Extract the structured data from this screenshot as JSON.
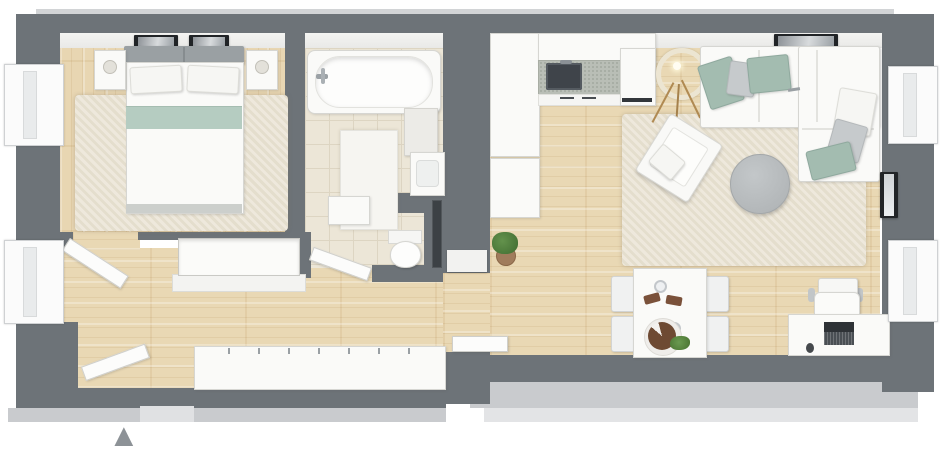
{
  "plan": {
    "name": "apartment-floor-plan-3d",
    "entrance_symbol": "▲"
  },
  "colors": {
    "wall": "#6d7378",
    "wall_outer_band": "#c9cbce",
    "wall_inner_face": "#f1f1ef",
    "wood_floor": "#e9d8b4",
    "bathroom_tile": "#ece6d7",
    "rug": "#e8e1d0",
    "furniture_white": "#fafaf8",
    "accent_sage": "#a3bcb0",
    "accent_gray": "#c6cacc",
    "headboard_gray": "#9aa0a3",
    "countertop_speckle": "#b9beb6",
    "dark_fixture": "#3c4145",
    "pouf_gray": "#b8bcbe",
    "lamp_ring": "#ece5d2",
    "lamp_legs": "#b08a52",
    "plant_green": "#4e7d3c",
    "cake_brown": "#6e4a33",
    "entrance_arrow": "#8d9297"
  },
  "rooms": {
    "bedroom": {
      "name": "bedroom",
      "items": [
        "double-bed",
        "headboard",
        "two-pillows",
        "sage-blanket-band",
        "nightstand-left",
        "nightstand-right",
        "table-lamps",
        "area-rug",
        "two-wall-art-frames",
        "window"
      ]
    },
    "bathroom": {
      "name": "bathroom",
      "items": [
        "bathtub",
        "tub-faucet",
        "bath-mat",
        "mirror-cabinet",
        "washbasin",
        "low-cabinet",
        "toilet",
        "towel-radiator",
        "tiled-floor"
      ]
    },
    "hallway": {
      "name": "hallway",
      "items": [
        "entrance-door",
        "entrance-arrow",
        "built-in-closet",
        "long-wardrobe",
        "door-to-bedroom",
        "door-to-bathroom",
        "door-to-living-room"
      ]
    },
    "living_room_kitchen": {
      "name": "living-room-with-kitchen",
      "items": [
        "kitchen-upper-cabinets",
        "countertop",
        "kitchen-sink",
        "appliance-front",
        "tall-cabinet-column",
        "potted-plant",
        "ring-floor-lamp",
        "corner-sofa",
        "six-throw-pillows",
        "wall-art",
        "round-pouf",
        "armchair",
        "area-rug",
        "dining-table",
        "four-dining-chairs",
        "cake-on-plate",
        "table-plant",
        "wood-serving-boards",
        "two-glasses",
        "desk",
        "office-chair",
        "laptop",
        "computer-mouse",
        "wall-photo-frame",
        "two-windows"
      ]
    }
  }
}
